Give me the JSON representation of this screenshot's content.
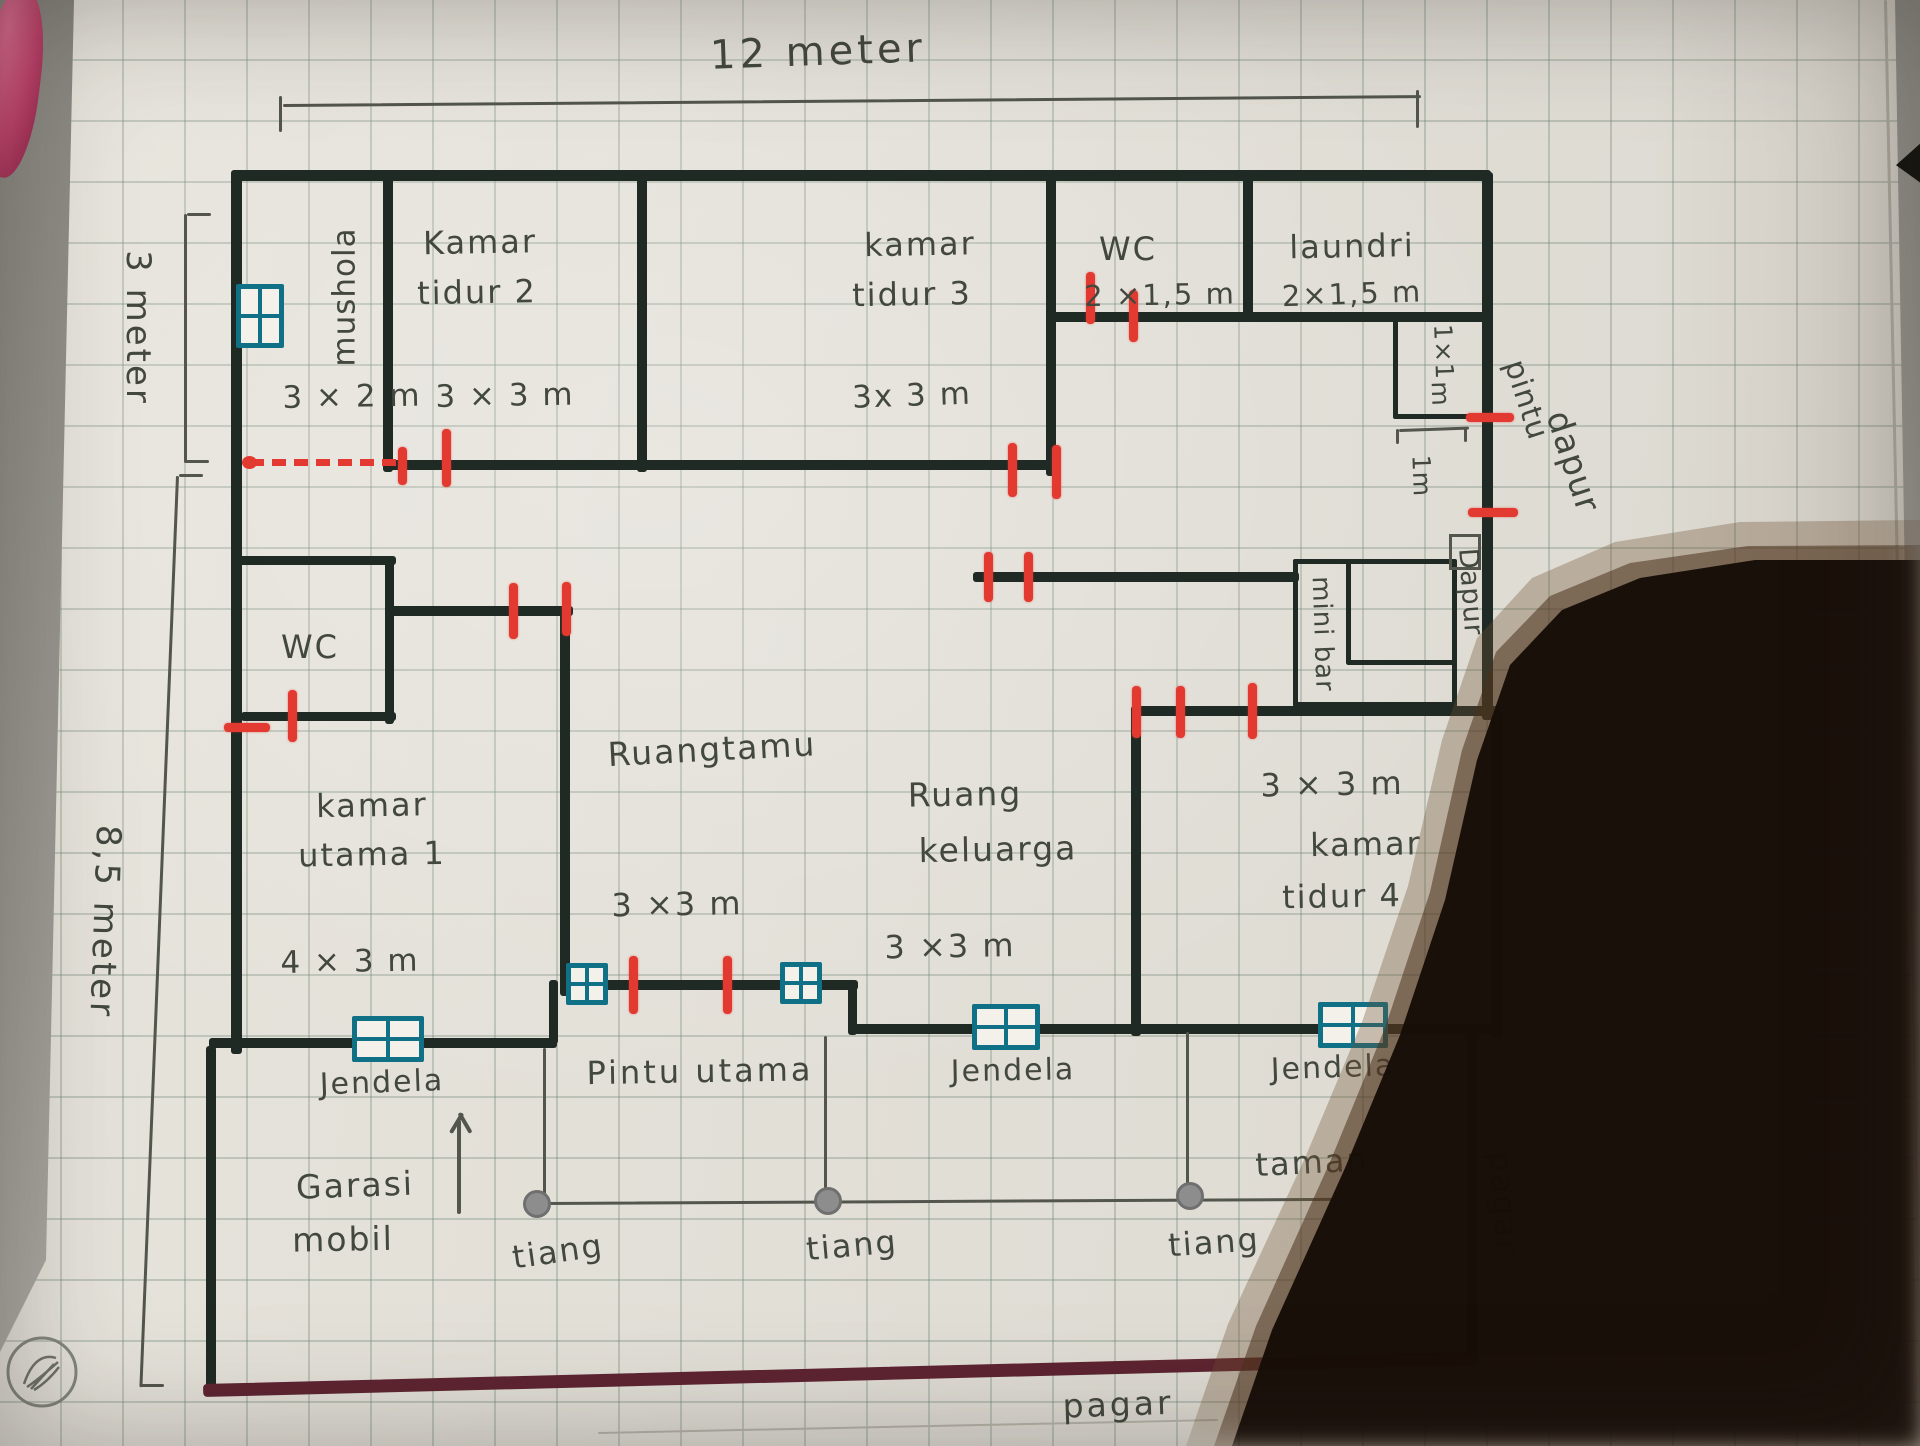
{
  "title": "hand-drawn house floor plan on graph paper",
  "colors": {
    "pen": "#1f2a24",
    "red": "#e23a31",
    "teal": "#107186",
    "pencil": "#53564d",
    "maroon": "#5e2431",
    "text": "#43483f"
  },
  "dimensions": {
    "top": "12 meter",
    "left_top": "3 meter",
    "left_bottom": "8,5 meter"
  },
  "labels": [
    {
      "name": "dim-top",
      "text": "12 meter",
      "x": 818,
      "y": 52,
      "size": 40,
      "rot": -2,
      "ls": 4
    },
    {
      "name": "dim-left-top",
      "text": "3 meter",
      "x": 137,
      "y": 328,
      "size": 34,
      "rot": 90,
      "ls": 3
    },
    {
      "name": "dim-left-bottom",
      "text": "8,5 meter",
      "x": 104,
      "y": 922,
      "size": 34,
      "rot": 92,
      "ls": 3
    },
    {
      "name": "room-mushola",
      "text": "mushola",
      "x": 345,
      "y": 297,
      "size": 31,
      "rot": -90,
      "ls": 1
    },
    {
      "name": "room-mushola-size",
      "text": "3 × 2 m",
      "x": 352,
      "y": 397,
      "size": 31,
      "rot": -1,
      "ls": 2
    },
    {
      "name": "room-kamar-tidur2-a",
      "text": "Kamar",
      "x": 480,
      "y": 243,
      "size": 32,
      "rot": -1,
      "ls": 2
    },
    {
      "name": "room-kamar-tidur2-b",
      "text": "tidur 2",
      "x": 477,
      "y": 293,
      "size": 32,
      "rot": -1,
      "ls": 2
    },
    {
      "name": "room-kamar-tidur2-size",
      "text": "3 × 3 m",
      "x": 505,
      "y": 396,
      "size": 31,
      "rot": -1,
      "ls": 2
    },
    {
      "name": "room-kamar-tidur3-a",
      "text": "kamar",
      "x": 920,
      "y": 245,
      "size": 32,
      "rot": -1,
      "ls": 2
    },
    {
      "name": "room-kamar-tidur3-b",
      "text": "tidur 3",
      "x": 912,
      "y": 295,
      "size": 32,
      "rot": -1,
      "ls": 2
    },
    {
      "name": "room-kamar-tidur3-size",
      "text": "3x 3 m",
      "x": 912,
      "y": 396,
      "size": 31,
      "rot": -2,
      "ls": 2
    },
    {
      "name": "room-wc-top",
      "text": "WC",
      "x": 1128,
      "y": 250,
      "size": 32,
      "rot": 0,
      "ls": 2
    },
    {
      "name": "room-wc-top-size",
      "text": "2 ×1,5 m",
      "x": 1160,
      "y": 295,
      "size": 29,
      "rot": -1,
      "ls": 2
    },
    {
      "name": "room-laundri",
      "text": "laundri",
      "x": 1352,
      "y": 247,
      "size": 32,
      "rot": -1,
      "ls": 2
    },
    {
      "name": "room-laundri-size",
      "text": "2×1,5 m",
      "x": 1352,
      "y": 294,
      "size": 29,
      "rot": -2,
      "ls": 2
    },
    {
      "name": "room-1x1-a",
      "text": "1×1",
      "x": 1443,
      "y": 352,
      "size": 25,
      "rot": 88,
      "ls": 1
    },
    {
      "name": "room-1x1-b",
      "text": "m",
      "x": 1440,
      "y": 394,
      "size": 25,
      "rot": 88,
      "ls": 1
    },
    {
      "name": "dim-1m",
      "text": "1m",
      "x": 1421,
      "y": 476,
      "size": 25,
      "rot": 88,
      "ls": 1
    },
    {
      "name": "label-pintu-dapur-a",
      "text": "pintu",
      "x": 1526,
      "y": 400,
      "size": 30,
      "rot": 72,
      "ls": 1
    },
    {
      "name": "label-pintu-dapur-b",
      "text": "dapur",
      "x": 1572,
      "y": 462,
      "size": 34,
      "rot": 72,
      "ls": 1
    },
    {
      "name": "room-dapur",
      "text": "Dapur",
      "x": 1470,
      "y": 592,
      "size": 27,
      "rot": 86,
      "ls": 1
    },
    {
      "name": "room-mini-bar",
      "text": "mini bar",
      "x": 1322,
      "y": 634,
      "size": 26,
      "rot": 88,
      "ls": 1
    },
    {
      "name": "room-wc-left",
      "text": "WC",
      "x": 310,
      "y": 648,
      "size": 32,
      "rot": 0,
      "ls": 2
    },
    {
      "name": "room-kamar-utama-a",
      "text": "kamar",
      "x": 372,
      "y": 806,
      "size": 32,
      "rot": -1,
      "ls": 2
    },
    {
      "name": "room-kamar-utama-b",
      "text": "utama 1",
      "x": 372,
      "y": 855,
      "size": 32,
      "rot": -1,
      "ls": 2
    },
    {
      "name": "room-kamar-utama-size",
      "text": "4 × 3 m",
      "x": 350,
      "y": 962,
      "size": 31,
      "rot": -1,
      "ls": 2
    },
    {
      "name": "room-ruang-tamu",
      "text": "Ruangtamu",
      "x": 712,
      "y": 750,
      "size": 33,
      "rot": -3,
      "ls": 2
    },
    {
      "name": "room-ruang-tamu-size",
      "text": "3 ×3 m",
      "x": 677,
      "y": 905,
      "size": 32,
      "rot": -1,
      "ls": 2
    },
    {
      "name": "room-ruang-keluarga-a",
      "text": "Ruang",
      "x": 965,
      "y": 795,
      "size": 33,
      "rot": -1,
      "ls": 2
    },
    {
      "name": "room-ruang-keluarga-b",
      "text": "keluarga",
      "x": 998,
      "y": 850,
      "size": 33,
      "rot": -1,
      "ls": 2
    },
    {
      "name": "room-ruang-keluarga-size",
      "text": "3 ×3 m",
      "x": 950,
      "y": 947,
      "size": 32,
      "rot": -1,
      "ls": 2
    },
    {
      "name": "room-kamar-tidur4-size",
      "text": "3 × 3 m",
      "x": 1332,
      "y": 785,
      "size": 32,
      "rot": -1,
      "ls": 2
    },
    {
      "name": "room-kamar-tidur4-a",
      "text": "kamar",
      "x": 1366,
      "y": 845,
      "size": 32,
      "rot": -1,
      "ls": 2
    },
    {
      "name": "room-kamar-tidur4-b",
      "text": "tidur 4",
      "x": 1342,
      "y": 897,
      "size": 32,
      "rot": -1,
      "ls": 2
    },
    {
      "name": "label-jendela-left",
      "text": "Jendela",
      "x": 382,
      "y": 1083,
      "size": 30,
      "rot": -2,
      "ls": 2
    },
    {
      "name": "label-pintu-utama",
      "text": "Pintu utama",
      "x": 700,
      "y": 1072,
      "size": 32,
      "rot": -1,
      "ls": 3
    },
    {
      "name": "label-jendela-mid",
      "text": "Jendela",
      "x": 1013,
      "y": 1071,
      "size": 30,
      "rot": -1,
      "ls": 2
    },
    {
      "name": "label-jendela-right",
      "text": "Jendela",
      "x": 1333,
      "y": 1068,
      "size": 30,
      "rot": -2,
      "ls": 2
    },
    {
      "name": "label-garasi-a",
      "text": "Garasi",
      "x": 355,
      "y": 1186,
      "size": 33,
      "rot": -2,
      "ls": 2
    },
    {
      "name": "label-garasi-b",
      "text": "mobil",
      "x": 343,
      "y": 1240,
      "size": 33,
      "rot": -1,
      "ls": 2
    },
    {
      "name": "label-tiang-1",
      "text": "tiang",
      "x": 558,
      "y": 1252,
      "size": 32,
      "rot": -8,
      "ls": 2
    },
    {
      "name": "label-tiang-2",
      "text": "tiang",
      "x": 852,
      "y": 1246,
      "size": 32,
      "rot": -5,
      "ls": 2
    },
    {
      "name": "label-tiang-3",
      "text": "tiang",
      "x": 1214,
      "y": 1243,
      "size": 32,
      "rot": -4,
      "ls": 2
    },
    {
      "name": "label-taman",
      "text": "taman",
      "x": 1312,
      "y": 1163,
      "size": 32,
      "rot": -3,
      "ls": 2
    },
    {
      "name": "label-pagar-right",
      "text": "pagar",
      "x": 1503,
      "y": 1203,
      "size": 32,
      "rot": 86,
      "ls": 2
    },
    {
      "name": "label-pagar-bottom",
      "text": "pagar",
      "x": 1118,
      "y": 1405,
      "size": 33,
      "rot": -2,
      "ls": 3
    }
  ],
  "walls": [
    {
      "name": "outer-top",
      "x": 235,
      "y": 170,
      "w": 1256,
      "h": 11
    },
    {
      "name": "outer-left-upper",
      "x": 231,
      "y": 170,
      "w": 11,
      "h": 884
    },
    {
      "name": "outer-left-garage",
      "x": 206,
      "y": 1046,
      "w": 10,
      "h": 348
    },
    {
      "name": "outer-right-a",
      "x": 1482,
      "y": 172,
      "w": 11,
      "h": 548
    },
    {
      "name": "outer-right-b",
      "x": 1491,
      "y": 712,
      "w": 11,
      "h": 326
    },
    {
      "name": "outer-right-c",
      "x": 1467,
      "y": 1030,
      "w": 10,
      "h": 334
    },
    {
      "name": "wall-mushola-kt2",
      "x": 383,
      "y": 172,
      "w": 10,
      "h": 300
    },
    {
      "name": "wall-kt2-kt3",
      "x": 637,
      "y": 176,
      "w": 10,
      "h": 296
    },
    {
      "name": "wall-kt3-wc",
      "x": 1046,
      "y": 176,
      "w": 10,
      "h": 300
    },
    {
      "name": "wall-wc-laundri",
      "x": 1243,
      "y": 176,
      "w": 10,
      "h": 146
    },
    {
      "name": "wall-kt23-bottom",
      "x": 383,
      "y": 460,
      "w": 676,
      "h": 10
    },
    {
      "name": "wall-wc-bottom",
      "x": 1050,
      "y": 312,
      "w": 205,
      "h": 10
    },
    {
      "name": "wall-laundri-bottom",
      "x": 1250,
      "y": 312,
      "w": 243,
      "h": 10
    },
    {
      "name": "wall-wcleft-top",
      "x": 236,
      "y": 556,
      "w": 160,
      "h": 9
    },
    {
      "name": "wall-wcleft-right",
      "x": 385,
      "y": 556,
      "w": 9,
      "h": 168
    },
    {
      "name": "wall-wcleft-bottom",
      "x": 241,
      "y": 712,
      "w": 155,
      "h": 9
    },
    {
      "name": "wall-corridor",
      "x": 389,
      "y": 606,
      "w": 184,
      "h": 10
    },
    {
      "name": "wall-ruangtamu-left",
      "x": 560,
      "y": 606,
      "w": 10,
      "h": 390
    },
    {
      "name": "wall-front-mid",
      "x": 560,
      "y": 980,
      "w": 298,
      "h": 10
    },
    {
      "name": "wall-step-right",
      "x": 848,
      "y": 980,
      "w": 9,
      "h": 55
    },
    {
      "name": "wall-front-right",
      "x": 848,
      "y": 1024,
      "w": 655,
      "h": 10
    },
    {
      "name": "wall-front-left",
      "x": 209,
      "y": 1038,
      "w": 348,
      "h": 10
    },
    {
      "name": "wall-step-left",
      "x": 549,
      "y": 980,
      "w": 9,
      "h": 64
    },
    {
      "name": "wall-dapur",
      "x": 973,
      "y": 572,
      "w": 326,
      "h": 10
    },
    {
      "name": "wall-rk-kt4",
      "x": 1131,
      "y": 706,
      "w": 10,
      "h": 330
    },
    {
      "name": "wall-kt4-top",
      "x": 1131,
      "y": 706,
      "w": 368,
      "h": 10
    },
    {
      "name": "minibar-inner-v",
      "x": 1346,
      "y": 559,
      "w": 5,
      "h": 106
    },
    {
      "name": "minibar-inner-h",
      "x": 1346,
      "y": 660,
      "w": 108,
      "h": 5
    }
  ],
  "pen_rects": [
    {
      "name": "room-1x1-box",
      "x": 1393,
      "y": 317,
      "w": 87,
      "h": 92
    },
    {
      "name": "minibar-box",
      "x": 1293,
      "y": 559,
      "w": 154,
      "h": 138
    }
  ],
  "pencil_rects": [
    {
      "name": "dapur-door-mark",
      "x": 1449,
      "y": 534,
      "w": 26,
      "h": 30
    }
  ],
  "red_ticks": [
    {
      "x": 402,
      "y": 466,
      "len": 38,
      "o": "v"
    },
    {
      "x": 446,
      "y": 458,
      "len": 58,
      "o": "v"
    },
    {
      "x": 1012,
      "y": 470,
      "len": 54,
      "o": "v"
    },
    {
      "x": 1056,
      "y": 472,
      "len": 54,
      "o": "v"
    },
    {
      "x": 1090,
      "y": 298,
      "len": 52,
      "o": "v"
    },
    {
      "x": 1133,
      "y": 316,
      "len": 52,
      "o": "v"
    },
    {
      "x": 1490,
      "y": 417,
      "len": 48,
      "o": "h"
    },
    {
      "x": 1493,
      "y": 512,
      "len": 50,
      "o": "h"
    },
    {
      "x": 988,
      "y": 577,
      "len": 50,
      "o": "v"
    },
    {
      "x": 1028,
      "y": 577,
      "len": 50,
      "o": "v"
    },
    {
      "x": 513,
      "y": 611,
      "len": 56,
      "o": "v"
    },
    {
      "x": 566,
      "y": 609,
      "len": 54,
      "o": "v"
    },
    {
      "x": 292,
      "y": 716,
      "len": 52,
      "o": "v"
    },
    {
      "x": 247,
      "y": 727,
      "len": 46,
      "o": "h"
    },
    {
      "x": 633,
      "y": 985,
      "len": 58,
      "o": "v"
    },
    {
      "x": 727,
      "y": 985,
      "len": 58,
      "o": "v"
    },
    {
      "x": 1136,
      "y": 712,
      "len": 52,
      "o": "v"
    },
    {
      "x": 1180,
      "y": 712,
      "len": 52,
      "o": "v"
    },
    {
      "x": 1252,
      "y": 711,
      "len": 56,
      "o": "v"
    }
  ],
  "dashed_opening": {
    "x": 250,
    "y": 459,
    "w": 146,
    "dot_x": 242,
    "dot_y": 456
  },
  "windows": [
    {
      "name": "window-mushola",
      "x": 236,
      "y": 284,
      "w": 48,
      "h": 64
    },
    {
      "name": "window-garasi",
      "x": 352,
      "y": 1016,
      "w": 72,
      "h": 46
    },
    {
      "name": "window-entry-left",
      "x": 566,
      "y": 963,
      "w": 42,
      "h": 42
    },
    {
      "name": "window-entry-right",
      "x": 780,
      "y": 962,
      "w": 42,
      "h": 42
    },
    {
      "name": "window-keluarga",
      "x": 972,
      "y": 1004,
      "w": 68,
      "h": 46
    },
    {
      "name": "window-kt4",
      "x": 1318,
      "y": 1002,
      "w": 70,
      "h": 46
    }
  ],
  "pencil_lines": [
    {
      "name": "dim-top-line",
      "x": 283,
      "y": 104,
      "len": 1138,
      "rot": -0.45,
      "th": 3
    },
    {
      "name": "dim-top-tick-l",
      "x": 282,
      "y": 96,
      "len": 36,
      "rot": 90,
      "th": 3
    },
    {
      "name": "dim-top-tick-r",
      "x": 1419,
      "y": 90,
      "len": 38,
      "rot": 90,
      "th": 3
    },
    {
      "name": "dim-left1-line",
      "x": 187,
      "y": 214,
      "len": 249,
      "rot": 90,
      "th": 3
    },
    {
      "name": "dim-left1-tick-a",
      "x": 187,
      "y": 213,
      "len": 24,
      "rot": 0,
      "th": 3
    },
    {
      "name": "dim-left1-tick-b",
      "x": 185,
      "y": 460,
      "len": 24,
      "rot": 0,
      "th": 3
    },
    {
      "name": "dim-left2-line",
      "x": 179,
      "y": 476,
      "len": 912,
      "rot": 92.3,
      "th": 3
    },
    {
      "name": "dim-left2-tick-a",
      "x": 179,
      "y": 474,
      "len": 24,
      "rot": 0,
      "th": 3
    },
    {
      "name": "dim-left2-tick-b",
      "x": 140,
      "y": 1384,
      "len": 24,
      "rot": 0,
      "th": 3
    },
    {
      "name": "dim-1m-bracket",
      "x": 1399,
      "y": 429,
      "len": 70,
      "rot": -2,
      "th": 3
    },
    {
      "name": "dim-1m-tick-a",
      "x": 1399,
      "y": 429,
      "len": 15,
      "rot": 90,
      "th": 3
    },
    {
      "name": "dim-1m-tick-b",
      "x": 1467,
      "y": 427,
      "len": 15,
      "rot": 90,
      "th": 3
    },
    {
      "name": "porch-line-1",
      "x": 546,
      "y": 1048,
      "len": 156,
      "rot": 90,
      "th": 3
    },
    {
      "name": "porch-line-2",
      "x": 827,
      "y": 1036,
      "len": 168,
      "rot": 90,
      "th": 3
    },
    {
      "name": "porch-line-3",
      "x": 1189,
      "y": 1032,
      "len": 166,
      "rot": 90,
      "th": 3
    },
    {
      "name": "porch-line-h",
      "x": 546,
      "y": 1202,
      "len": 786,
      "rot": -0.3,
      "th": 3
    },
    {
      "name": "north-arrow-shaft",
      "x": 461,
      "y": 1120,
      "len": 94,
      "rot": 90,
      "th": 4
    },
    {
      "name": "north-arrow-head-l",
      "x": 449,
      "y": 1132,
      "len": 23,
      "rot": -59,
      "th": 4
    },
    {
      "name": "north-arrow-head-r",
      "x": 461,
      "y": 1112,
      "len": 23,
      "rot": 60,
      "th": 4
    },
    {
      "name": "paper-edge-right",
      "x": 1887,
      "y": 0,
      "len": 640,
      "rot": 88.8,
      "th": 3,
      "color": "#aaa79e"
    },
    {
      "name": "paper-edge-bottom",
      "x": 598,
      "y": 1432,
      "len": 620,
      "rot": -1.2,
      "th": 2,
      "color": "#b8b5ac"
    }
  ],
  "columns": [
    {
      "name": "tiang-circle-1",
      "x": 537,
      "y": 1204
    },
    {
      "name": "tiang-circle-2",
      "x": 828,
      "y": 1201
    },
    {
      "name": "tiang-circle-3",
      "x": 1190,
      "y": 1196
    }
  ],
  "fence": {
    "x": 203,
    "y": 1384,
    "len": 1276,
    "rot": -1.44,
    "th": 13
  }
}
